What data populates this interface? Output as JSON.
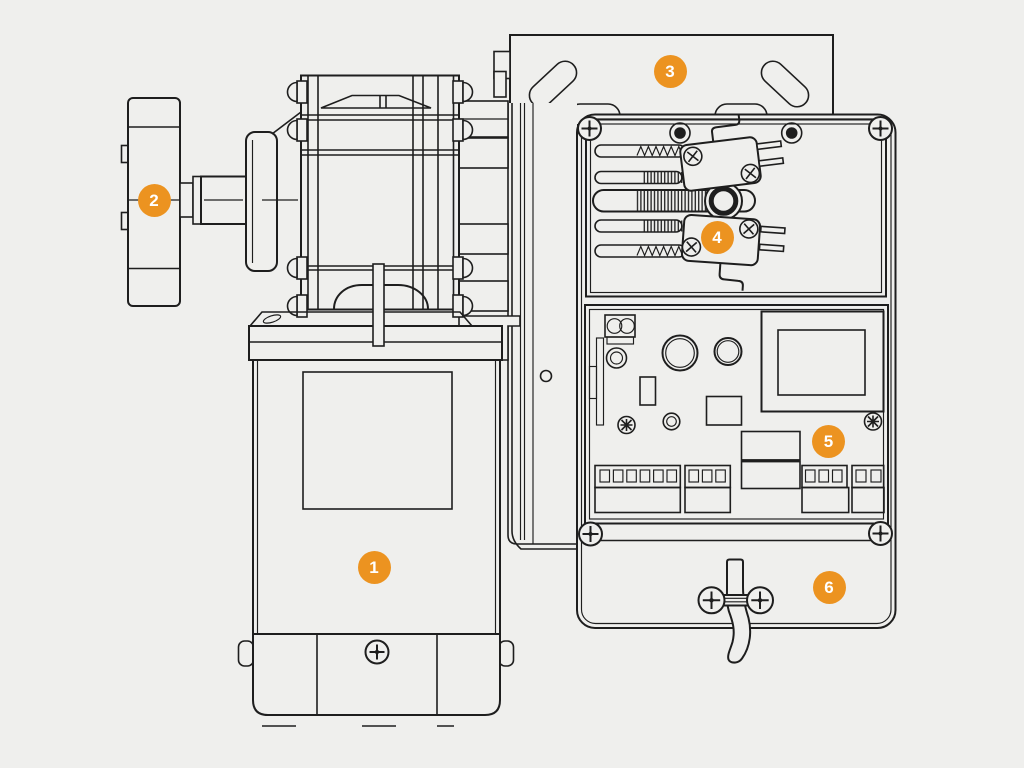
{
  "diagram": {
    "colors": {
      "background": "#efefed",
      "line": "#1e1e1e",
      "accent": "#ec9320",
      "badge_text": "#ffffff"
    },
    "callouts": [
      {
        "number": "1"
      },
      {
        "number": "2"
      },
      {
        "number": "3"
      },
      {
        "number": "4"
      },
      {
        "number": "5"
      },
      {
        "number": "6"
      }
    ]
  }
}
